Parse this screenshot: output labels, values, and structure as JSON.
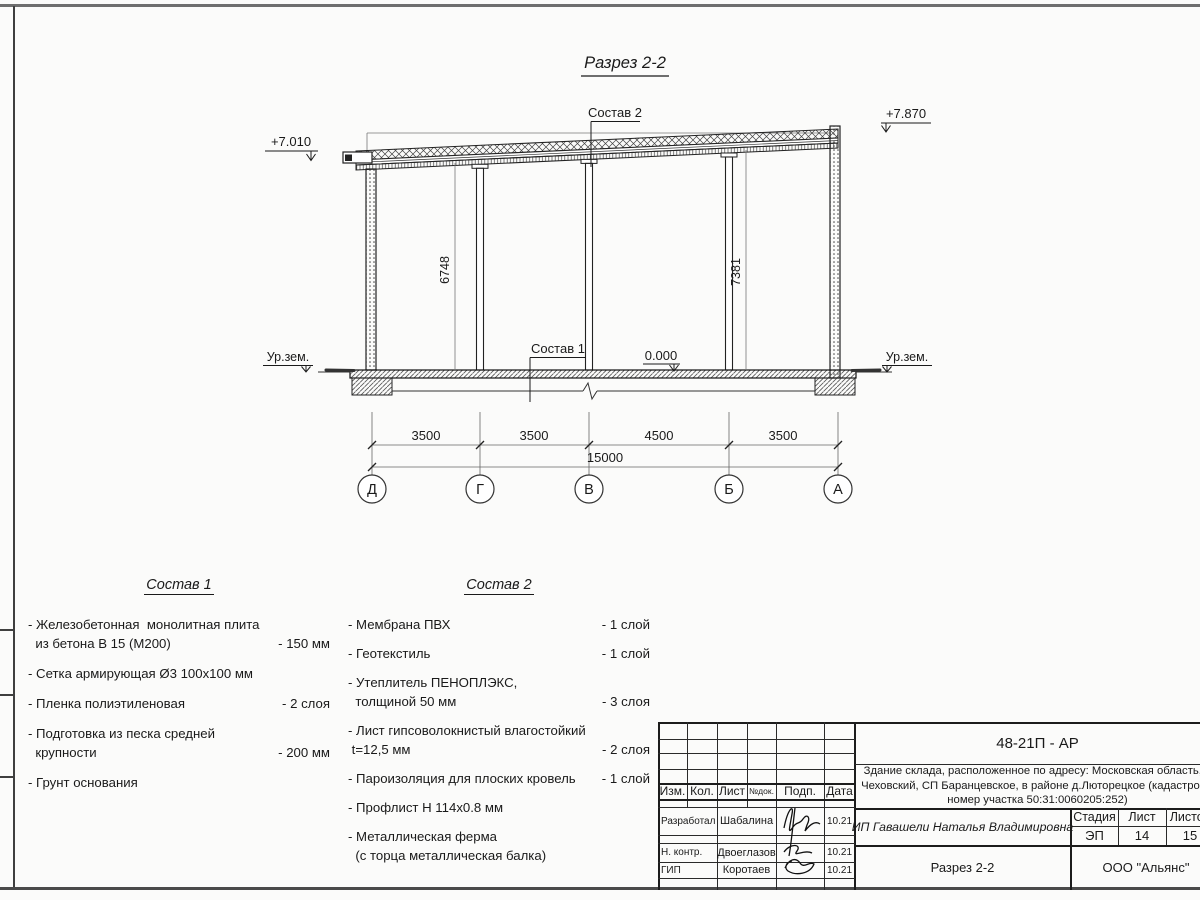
{
  "drawing": {
    "title": "Разрез 2-2",
    "elev_left": "+7.010",
    "elev_right": "+7.870",
    "ground_left": "Ур.зем.",
    "ground_right": "Ур.зем.",
    "zero": "0.000",
    "h_left": "6748",
    "h_right": "7381",
    "callout_top": "Состав 2",
    "callout_floor": "Состав 1",
    "dims": {
      "d0": "3500",
      "d1": "3500",
      "d2": "4500",
      "d3": "3500",
      "total": "15000"
    },
    "axes": {
      "a0": "Д",
      "a1": "Г",
      "a2": "В",
      "a3": "Б",
      "a4": "А"
    }
  },
  "sostav1": {
    "title": "Состав 1",
    "items": [
      {
        "text": "- Железобетонная  монолитная плита\n  из бетона В 15 (М200)",
        "value": "- 150 мм"
      },
      {
        "text": "- Сетка армирующая Ø3 100х100 мм",
        "value": ""
      },
      {
        "text": "- Пленка полиэтиленовая",
        "value": "-  2 слоя"
      },
      {
        "text": "- Подготовка из песка средней\n  крупности",
        "value": "- 200 мм"
      },
      {
        "text": "- Грунт основания",
        "value": ""
      }
    ]
  },
  "sostav2": {
    "title": "Состав 2",
    "items": [
      {
        "text": "- Мембрана ПВХ",
        "value": "- 1 слой"
      },
      {
        "text": "- Геотекстиль",
        "value": "- 1 слой"
      },
      {
        "text": "- Утеплитель ПЕНОПЛЭКС,\n  толщиной 50 мм",
        "value": "- 3 слоя"
      },
      {
        "text": "- Лист гипсоволокнистый влагостойкий\n t=12,5 мм",
        "value": "- 2 слоя"
      },
      {
        "text": "- Пароизоляция для плоских кровель",
        "value": "- 1 слой"
      },
      {
        "text": "- Профлист Н 114х0.8 мм",
        "value": ""
      },
      {
        "text": "- Металлическая ферма\n  (с торца металлическая балка)",
        "value": ""
      }
    ]
  },
  "titleblock": {
    "code": "48-21П - АР",
    "description": "Здание склада, расположенное по адресу: Московская область, р\nЧеховский, СП Баранцевское, в районе д.Люторецкое  (кадастровы\nномер участка 50:31:0060205:252)",
    "header": {
      "izm": "Изм.",
      "kol": "Кол.",
      "list": "Лист",
      "ndok": "№док.",
      "podp": "Подп.",
      "data": "Дата"
    },
    "rows": [
      {
        "role": "Разработал",
        "name": "Шабалина",
        "date": "10.21"
      },
      {
        "role": "Н. контр.",
        "name": "Двоеглазов",
        "date": "10.21"
      },
      {
        "role": "ГИП",
        "name": "Коротаев",
        "date": "10.21"
      }
    ],
    "client": "ИП Гавашели Наталья Владимировна",
    "stage_label": "Стадия",
    "sheet_label": "Лист",
    "sheets_label": "Листов",
    "stage": "ЭП",
    "sheet": "14",
    "sheets": "15",
    "section": "Разрез 2-2",
    "company": "ООО \"Альянс\""
  }
}
